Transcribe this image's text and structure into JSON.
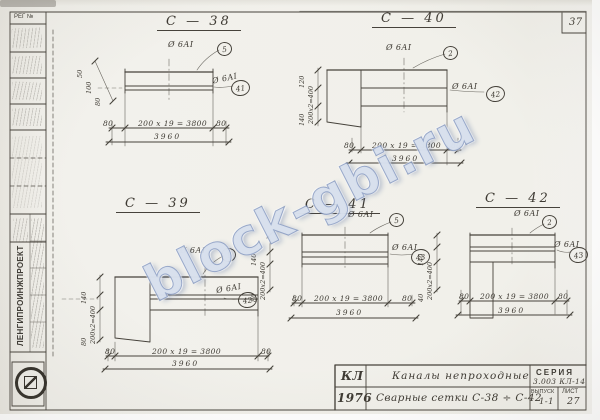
{
  "sheet": {
    "corner_number": "37",
    "reg_label": "РЕГ №",
    "org_name": "ЛЕНГИПРОИНЖПРОЕКТ"
  },
  "watermark": {
    "text": "block-gbi.ru",
    "color": "#7d96c8"
  },
  "colors": {
    "paper": "#f1f0eb",
    "ink": "#46423b"
  },
  "diagrams": [
    {
      "id": "С-38",
      "title": "С — 38",
      "bar_mark": "Ø 6АI",
      "pos_top": "5",
      "pos_side": "41",
      "dim_spacing": "200 х 19 = 3800",
      "dim_total": "3960",
      "dim_end_left": "80",
      "dim_end_right": "80",
      "side_dims": [
        "50",
        "100",
        "80"
      ]
    },
    {
      "id": "С-40",
      "title": "С — 40",
      "bar_mark": "Ø 6АI",
      "pos_top": "2",
      "pos_side": "42",
      "dim_spacing": "200 х 19 = 3800",
      "dim_total": "3960",
      "dim_end_left": "80",
      "dim_end_right": "80",
      "side_dims": [
        "120",
        "200х2=400",
        "140"
      ]
    },
    {
      "id": "С-39",
      "title": "С — 39",
      "bar_mark": "Ø 6АI",
      "pos_top": "1",
      "pos_side": "42",
      "dim_spacing": "200 х 19 = 3800",
      "dim_total": "3960",
      "dim_end_left": "80",
      "dim_end_right": "80",
      "side_dims": [
        "140",
        "200х2=400",
        "80"
      ]
    },
    {
      "id": "С-41",
      "title": "С — 41",
      "bar_mark": "Ø 6АI",
      "pos_top": "5",
      "pos_side": "43",
      "dim_spacing": "200 х 19 = 3800",
      "dim_total": "3960",
      "dim_end_left": "80",
      "dim_end_right": "80",
      "side_dims": [
        "140",
        "200х2=400",
        "80"
      ]
    },
    {
      "id": "С-42",
      "title": "С — 42",
      "bar_mark": "Ø 6АI",
      "pos_top": "2",
      "pos_side": "43",
      "dim_spacing": "200 х 19 = 3800",
      "dim_total": "3960",
      "dim_end_left": "80",
      "dim_end_right": "80",
      "side_dims": [
        "140",
        "200х2=400",
        "40"
      ]
    }
  ],
  "title_block": {
    "code": "КЛ",
    "year": "1976",
    "row1": "Каналы непроходные",
    "row2": "Сварные сетки  С-38 ÷ С-42",
    "series_label": "СЕРИЯ",
    "series_value": "3.003 КЛ-14",
    "issue_label": "ВЫПУСК",
    "issue_value": "1-1",
    "sheet_label": "ЛИСТ",
    "sheet_value": "27"
  }
}
